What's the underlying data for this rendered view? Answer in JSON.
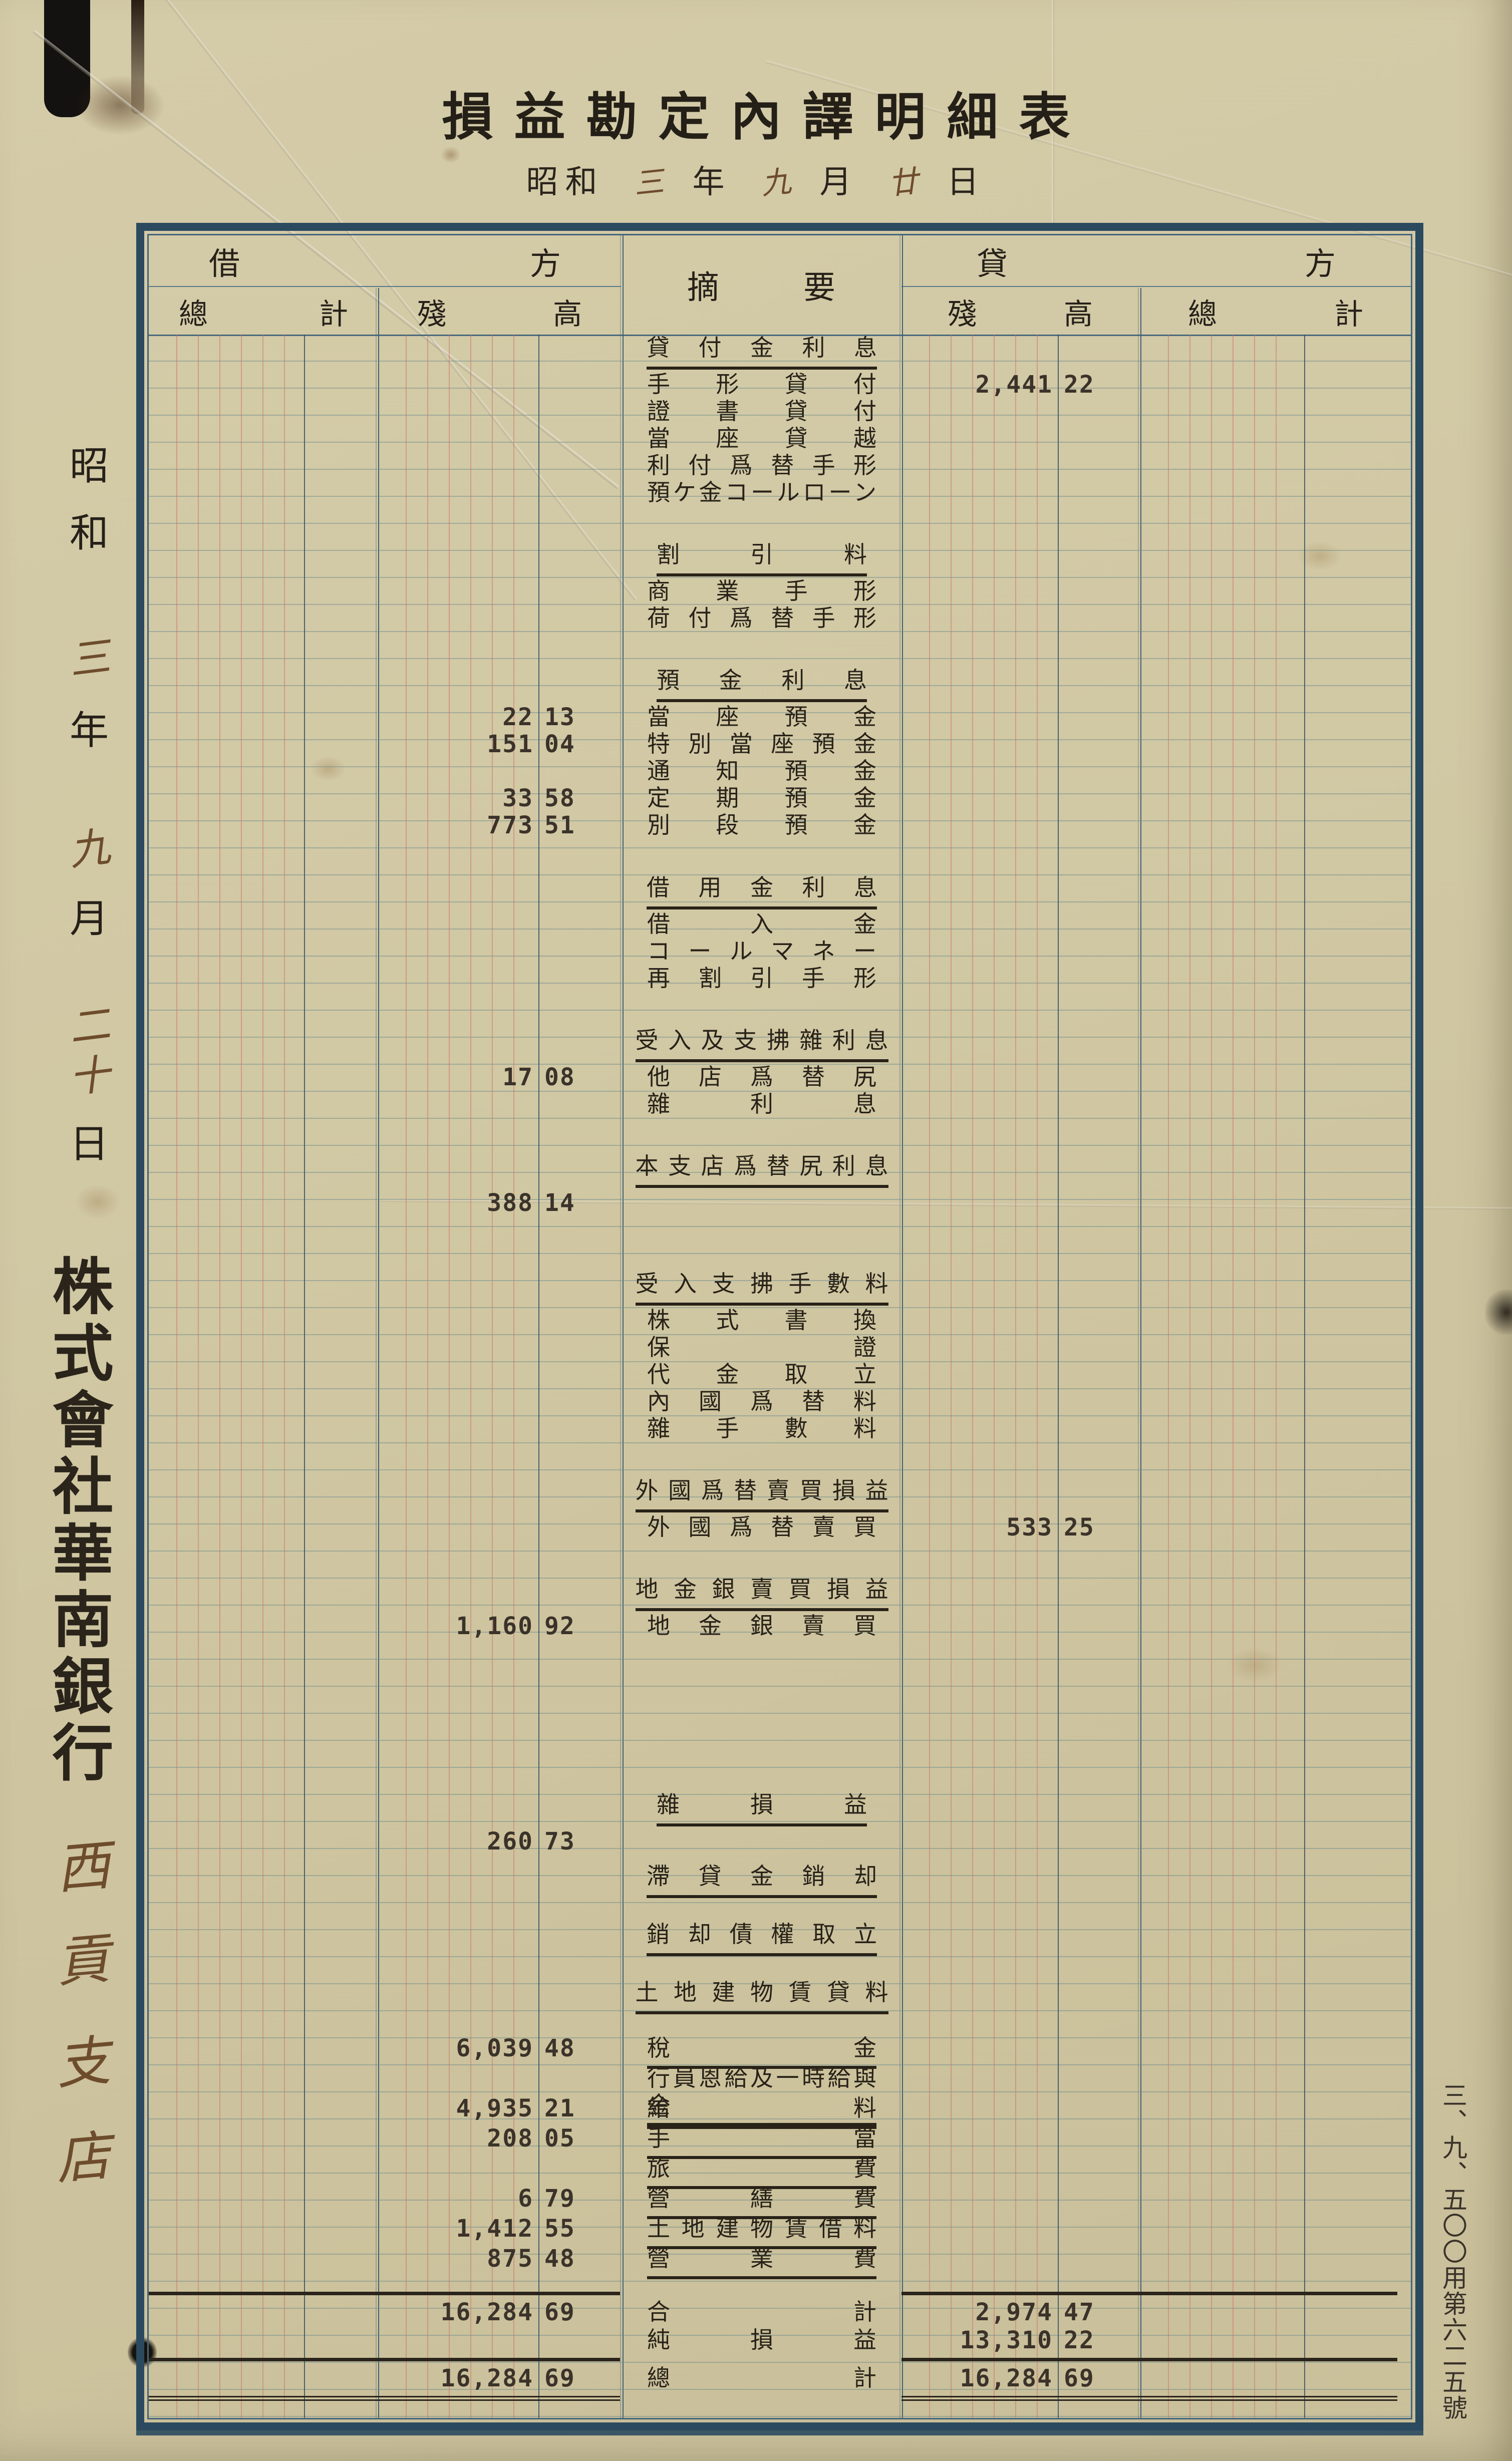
{
  "document": {
    "title": "損益勘定內譯明細表",
    "date_line": {
      "parts": [
        {
          "text": "昭和",
          "hand": false
        },
        {
          "text": "三",
          "hand": true
        },
        {
          "text": "年",
          "hand": false
        },
        {
          "text": "九",
          "hand": true
        },
        {
          "text": "月",
          "hand": false
        },
        {
          "text": "廿",
          "hand": true
        },
        {
          "text": "日",
          "hand": false
        }
      ]
    },
    "left_margin": {
      "date_chars": [
        {
          "text": "昭",
          "hand": false
        },
        {
          "text": "和",
          "hand": false
        },
        {
          "text": "三",
          "hand": true
        },
        {
          "text": "年",
          "hand": false
        },
        {
          "text": "九",
          "hand": true
        },
        {
          "text": "月",
          "hand": false
        },
        {
          "text": "二",
          "hand": true
        },
        {
          "text": "十",
          "hand": true
        },
        {
          "text": "日",
          "hand": false
        }
      ],
      "company": "株式會社華南銀行",
      "branch": "西貢支店"
    },
    "right_margin": {
      "form_number": "三、九、五〇〇用第六二五號"
    }
  },
  "table": {
    "headers": {
      "debit": "借方",
      "credit": "貸方",
      "summary": "摘要",
      "debit_col_total": "總計",
      "debit_col_balance": "殘高",
      "credit_col_balance": "殘高",
      "credit_col_total": "總計"
    },
    "rows": [
      {
        "type": "group",
        "label": "貸付金利息"
      },
      {
        "type": "entry",
        "label": "手形貸付",
        "credit": {
          "amount": "2,441",
          "cents": "22"
        }
      },
      {
        "type": "entry",
        "label": "證書貸付"
      },
      {
        "type": "entry",
        "label": "當座貸越"
      },
      {
        "type": "entry",
        "label": "利付爲替手形"
      },
      {
        "type": "entry",
        "label": "預ケ金コールローン"
      },
      {
        "type": "blank",
        "lines": 1.3
      },
      {
        "type": "group",
        "label": "割引料"
      },
      {
        "type": "entry",
        "label": "商業手形"
      },
      {
        "type": "entry",
        "label": "荷付爲替手形"
      },
      {
        "type": "blank",
        "lines": 1.3
      },
      {
        "type": "group",
        "label": "預金利息"
      },
      {
        "type": "entry",
        "label": "當座預金",
        "debit": {
          "amount": "22",
          "cents": "13"
        }
      },
      {
        "type": "entry",
        "label": "特別當座預金",
        "debit": {
          "amount": "151",
          "cents": "04"
        }
      },
      {
        "type": "entry",
        "label": "通知預金"
      },
      {
        "type": "entry",
        "label": "定期預金",
        "debit": {
          "amount": "33",
          "cents": "58"
        }
      },
      {
        "type": "entry",
        "label": "別段預金",
        "debit": {
          "amount": "773",
          "cents": "51"
        }
      },
      {
        "type": "blank",
        "lines": 1.3
      },
      {
        "type": "group",
        "label": "借用金利息"
      },
      {
        "type": "entry",
        "label": "借入金"
      },
      {
        "type": "entry",
        "label": "コールマネー"
      },
      {
        "type": "entry",
        "label": "再割引手形"
      },
      {
        "type": "blank",
        "lines": 1.3
      },
      {
        "type": "group",
        "label": "受入及支拂雜利息"
      },
      {
        "type": "entry",
        "label": "他店爲替尻",
        "debit": {
          "amount": "17",
          "cents": "08"
        }
      },
      {
        "type": "entry",
        "label": "雜利息"
      },
      {
        "type": "blank",
        "lines": 1.3
      },
      {
        "type": "group",
        "label": "本支店爲替尻利息"
      },
      {
        "type": "entry",
        "label": "",
        "debit": {
          "amount": "388",
          "cents": "14"
        }
      },
      {
        "type": "blank",
        "lines": 2.0
      },
      {
        "type": "group",
        "label": "受入支拂手數料"
      },
      {
        "type": "entry",
        "label": "株式書換"
      },
      {
        "type": "entry",
        "label": "保證"
      },
      {
        "type": "entry",
        "label": "代金取立"
      },
      {
        "type": "entry",
        "label": "內國爲替料"
      },
      {
        "type": "entry",
        "label": "雜手數料"
      },
      {
        "type": "blank",
        "lines": 1.3
      },
      {
        "type": "group",
        "label": "外國爲替賣買損益"
      },
      {
        "type": "entry",
        "label": "外國爲替賣買",
        "credit": {
          "amount": "533",
          "cents": "25"
        }
      },
      {
        "type": "blank",
        "lines": 1.3
      },
      {
        "type": "group",
        "label": "地金銀賣買損益"
      },
      {
        "type": "entry",
        "label": "地金銀賣買",
        "debit": {
          "amount": "1,160",
          "cents": "92"
        }
      },
      {
        "type": "blank",
        "lines": 5.6
      },
      {
        "type": "group",
        "label": "雜損益"
      },
      {
        "type": "entry",
        "label": "",
        "debit": {
          "amount": "260",
          "cents": "73"
        }
      },
      {
        "type": "blank",
        "lines": 0.3
      },
      {
        "type": "group",
        "label": "滯貸金銷却"
      },
      {
        "type": "blank",
        "lines": 0.8
      },
      {
        "type": "group",
        "label": "銷却債權取立"
      },
      {
        "type": "blank",
        "lines": 0.8
      },
      {
        "type": "group",
        "label": "土地建物賃貸料"
      },
      {
        "type": "blank",
        "lines": 0.7
      },
      {
        "type": "expense",
        "label": "稅金",
        "debit": {
          "amount": "6,039",
          "cents": "48"
        }
      },
      {
        "type": "expense",
        "label": "行員恩給及一時給與金"
      },
      {
        "type": "expense",
        "label": "給料",
        "debit": {
          "amount": "4,935",
          "cents": "21"
        }
      },
      {
        "type": "expense",
        "label": "手當",
        "debit": {
          "amount": "208",
          "cents": "05"
        }
      },
      {
        "type": "expense",
        "label": "旅費"
      },
      {
        "type": "expense",
        "label": "營繕費",
        "debit": {
          "amount": "6",
          "cents": "79"
        }
      },
      {
        "type": "expense",
        "label": "土地建物賃借料",
        "debit": {
          "amount": "1,412",
          "cents": "55"
        }
      },
      {
        "type": "expense",
        "label": "營業費",
        "debit": {
          "amount": "875",
          "cents": "48"
        }
      },
      {
        "type": "blank",
        "lines": 0.5
      },
      {
        "type": "rule"
      },
      {
        "type": "summary",
        "label": "合計",
        "debit": {
          "amount": "16,284",
          "cents": "69"
        },
        "credit": {
          "amount": "2,974",
          "cents": "47"
        }
      },
      {
        "type": "summary",
        "label": "純損益",
        "credit": {
          "amount": "13,310",
          "cents": "22"
        }
      },
      {
        "type": "rule"
      },
      {
        "type": "summary",
        "label": "總計",
        "debit": {
          "amount": "16,284",
          "cents": "69"
        },
        "credit": {
          "amount": "16,284",
          "cents": "69"
        }
      },
      {
        "type": "doublerule"
      }
    ]
  },
  "colors": {
    "paper": "#d1c8a4",
    "border_navy": "#2b4a5f",
    "ink": "#262019",
    "stamp_ink": "#3b332a",
    "handwriting_ink": "#6d4c2c",
    "ruling_red": "#ca705e",
    "ruling_blue": "#6e8c8a"
  }
}
